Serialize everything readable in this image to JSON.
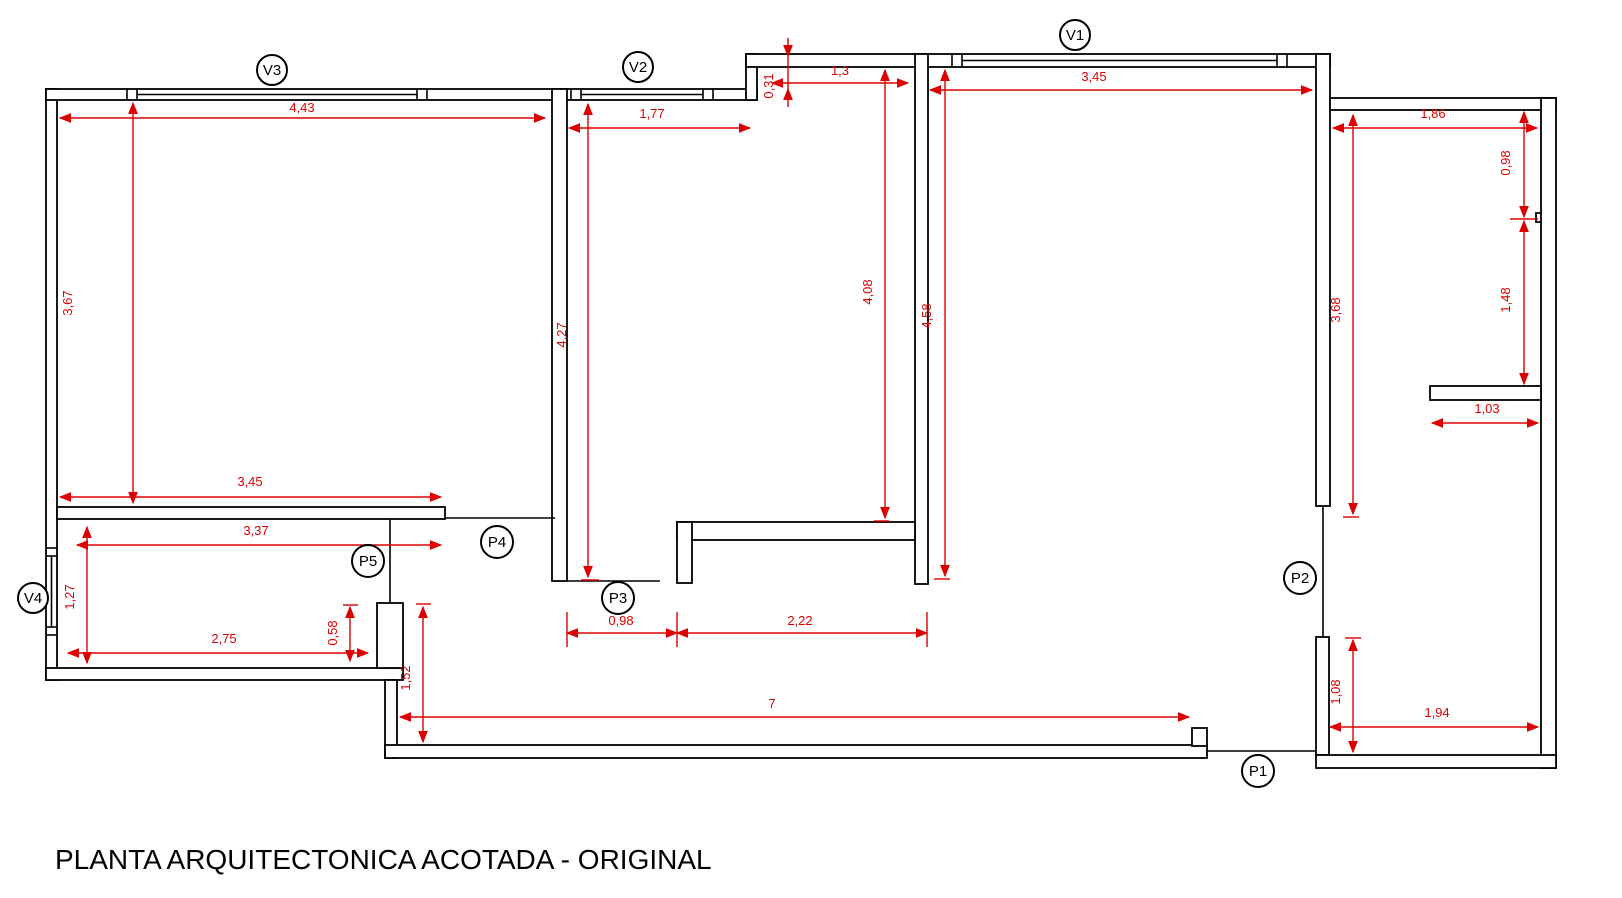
{
  "title": "PLANTA ARQUITECTONICA ACOTADA - ORIGINAL",
  "colors": {
    "wall": "#000000",
    "dimension": "#dd0000",
    "background": "#ffffff"
  },
  "labels": {
    "v1": "V1",
    "v2": "V2",
    "v3": "V3",
    "v4": "V4",
    "p1": "P1",
    "p2": "P2",
    "p3": "P3",
    "p4": "P4",
    "p5": "P5"
  },
  "dims": {
    "a_width": "4,43",
    "a_height": "3,67",
    "a_bottom_width": "3,45",
    "b_top_width": "1,77",
    "b_height": "4,27",
    "b_step": "0,31",
    "b_nook_width": "1,3",
    "b_inner_height": "4,08",
    "c_top_width": "3,45",
    "c_height": "4,58",
    "d_top_width": "1,86",
    "d_right_upper": "0,98",
    "d_right_lower": "1,48",
    "d_left_height": "3,68",
    "d_shelf_width": "1,03",
    "d_lower_height": "1,08",
    "d_bottom_width": "1,94",
    "e_height": "1,27",
    "e_top_width": "3,37",
    "e_bottom_width": "2,75",
    "e_stub": "0,58",
    "corridor_height": "1,52",
    "corridor_width": "7",
    "p3_left": "0,98",
    "p3_right": "2,22"
  }
}
